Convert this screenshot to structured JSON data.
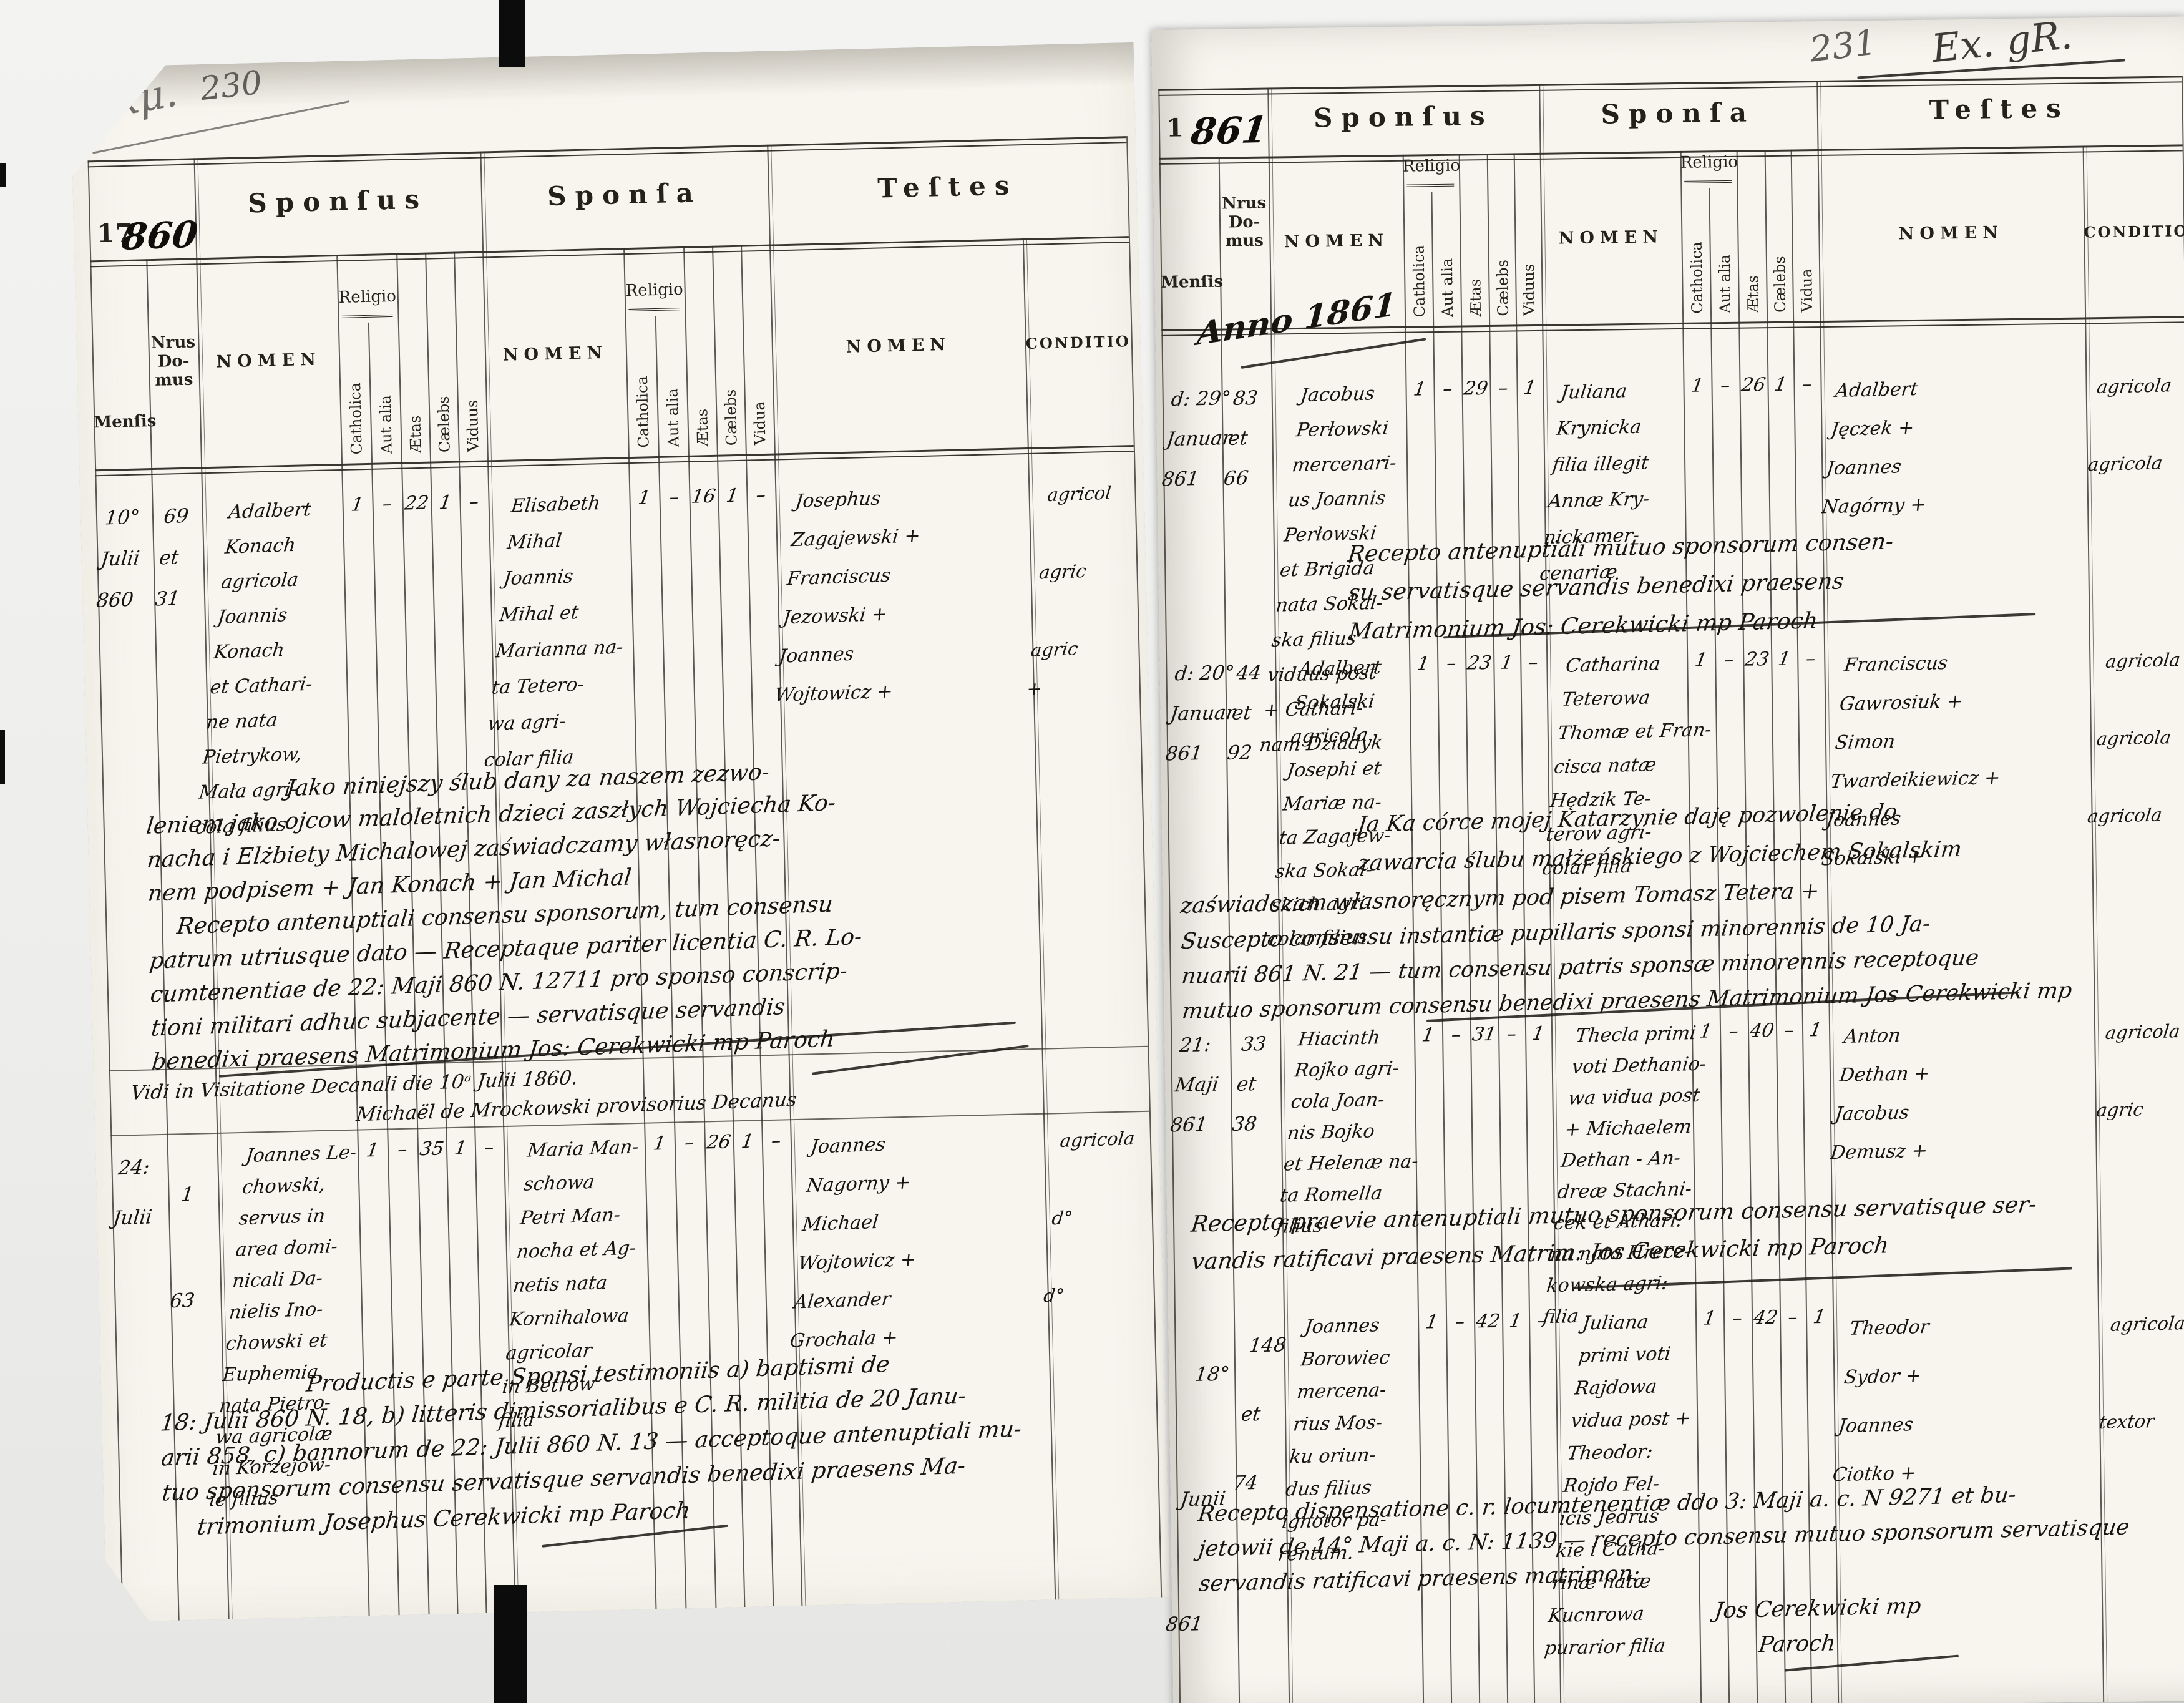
{
  "scan": {
    "left_page_number": "230",
    "right_page_number": "231",
    "left_corner_scribble": "Exμ.",
    "right_corner_scribble": "Ex. gR.",
    "ink_color": "#17140f",
    "pencil_color": "#6f6d68",
    "paper_color": "#f7f5ee"
  },
  "headers": {
    "sponsus": "Sponſus",
    "sponsa": "Sponſa",
    "testes": "Teſtes",
    "mensis": "Menſis",
    "nrus_lines": [
      "Nrus",
      "Do-",
      "mus"
    ],
    "nomen": "NOMEN",
    "conditio": "CONDITIO",
    "religio": "Religio",
    "catholica": "Catholica",
    "aut_alia": "Aut alia",
    "aetas": "Ætas",
    "caelebs": "Cælebs",
    "viduus": "Viduus",
    "vidua": "Vidua"
  },
  "left_page": {
    "year_printed": "17",
    "year_written": "860",
    "records": [
      {
        "mensis": [
          "10°",
          "Julii",
          "860"
        ],
        "nrus": [
          "69",
          "et",
          "31"
        ],
        "sponsus": [
          "Adalbert",
          "Konach",
          "agricola",
          "Joannis",
          "Konach",
          "et Cathari-",
          "ne nata",
          "Pietrykow,",
          "Mała agri-",
          "cola filius"
        ],
        "sponsus_marks": [
          "1",
          "–",
          "22",
          "1",
          "–"
        ],
        "sponsa": [
          "Elisabeth",
          "Mihal",
          "Joannis",
          "Mihal et",
          "Marianna na-",
          "ta Tetero-",
          "wa agri-",
          "colar filia"
        ],
        "sponsa_marks": [
          "1",
          "–",
          "16",
          "1",
          "–"
        ],
        "testes": [
          "Josephus",
          "Zagajewski +",
          "Franciscus",
          "Jezowski +",
          "Joannes",
          "Wojtowicz +"
        ],
        "conditio": [
          "agricol",
          "",
          "agric",
          "",
          "agric",
          "+"
        ]
      },
      {
        "mensis": [
          "24:",
          "Julii"
        ],
        "nrus": [
          "1",
          "63"
        ],
        "sponsus": [
          "Joannes Le-",
          "chowski,",
          "servus in",
          "area domi-",
          "nicali Da-",
          "nielis Ino-",
          "chowski et",
          "Euphemia",
          "nata Pietro-",
          "wa agricolæ",
          "in Korzejow-",
          "ie filius"
        ],
        "sponsus_marks": [
          "1",
          "–",
          "35",
          "1",
          "–"
        ],
        "sponsa": [
          "Maria Man-",
          "schowa",
          "Petri Man-",
          "nocha et Ag-",
          "netis nata",
          "Kornihalowa",
          "agricolar",
          "in Betrow",
          "filia"
        ],
        "sponsa_marks": [
          "1",
          "–",
          "26",
          "1",
          "–"
        ],
        "testes": [
          "Joannes",
          "Nagorny +",
          "Michael",
          "Wojtowicz +",
          "Alexander",
          "Grochala +"
        ],
        "conditio": [
          "agricola",
          "",
          "d°",
          "",
          "d°",
          ""
        ]
      }
    ],
    "notes": [
      {
        "lines": [
          "Jako niniejszy ślub dany za naszem zezwo-",
          "leniem jako ojcow maloletnich dzieci zaszłych Wojciecha Ko-",
          "nacha i Elżbiety Michalowej zaświadczamy własnoręcz-",
          "nem podpisem  + Jan Konach   + Jan Michal",
          "Recepto antenuptiali consensu sponsorum, tum consensu",
          "patrum utriusque dato — Receptaque pariter licentia C. R. Lo-",
          "cumtenentiae de 22: Maji 860 N. 12711 pro sponso conscrip-",
          "tioni militari adhuc subjacente — servatisque servandis",
          "benedixi praesens  Matrimonium  Jos: Cerekwicki mp   Paroch"
        ]
      },
      {
        "lines": [
          "Vidi in Visitatione Decanali die 10ᵃ Julii 1860.",
          "Michaël de Mrockowski provisorius Decanus"
        ]
      },
      {
        "lines": [
          "Productis e parte Sponsi testimoniis a) baptismi de",
          "18: Julii 860 N. 18, b) litteris dimissorialibus e C. R. militia de 20 Janu-",
          "arii 858, c) bannorum de 22: Julii 860 N. 13 — acceptoque antenuptiali mu-",
          "tuo sponsorum consensu servatisque servandis benedixi praesens Ma-",
          "trimonium    Josephus Cerekwicki mp     Paroch"
        ]
      }
    ]
  },
  "right_page": {
    "year_printed": "1",
    "year_written": "861",
    "anno": "Anno 1861",
    "records": [
      {
        "mensis": [
          "d: 29°",
          "Januar",
          "861"
        ],
        "nrus": [
          "83",
          "et",
          "66"
        ],
        "sponsus": [
          "Jacobus",
          "Perłowski",
          "mercenari-",
          "us Joannis",
          "Perłowski",
          "et Brigida",
          "nata Sokal-",
          "ska filius",
          "viduus post",
          "+ Cathari-",
          "nam Dziadyk"
        ],
        "sponsus_marks": [
          "1",
          "–",
          "29",
          "–",
          "1"
        ],
        "sponsa": [
          "Juliana",
          "Krynicka",
          "filia illegit",
          "Annæ Kry-",
          "nickamer-",
          "cenariæ"
        ],
        "sponsa_marks": [
          "1",
          "–",
          "26",
          "1",
          "–"
        ],
        "testes": [
          "Adalbert",
          "Jęczek +",
          "Joannes",
          "Nagórny +"
        ],
        "conditio": [
          "agricola",
          "",
          "agricola",
          ""
        ]
      },
      {
        "mensis": [
          "d: 20°",
          "Januar",
          "861"
        ],
        "nrus": [
          "44",
          "et",
          "92"
        ],
        "sponsus": [
          "Adalbert",
          "Sokalski",
          "agricola",
          "Josephi et",
          "Mariæ na-",
          "ta Zagajew-",
          "ska Sokal-",
          "skich agri-",
          "colar filius"
        ],
        "sponsus_marks": [
          "1",
          "–",
          "23",
          "1",
          "–"
        ],
        "sponsa": [
          "Catharina",
          "Teterowa",
          "Thomæ et Fran-",
          "cisca natæ",
          "Hędzik Te-",
          "terow agri-",
          "colar filia"
        ],
        "sponsa_marks": [
          "1",
          "–",
          "23",
          "1",
          "–"
        ],
        "testes": [
          "Franciscus",
          "Gawrosiuk +",
          "Simon",
          "Twardeikiewicz +",
          "Joannes",
          "Sokalski +"
        ],
        "conditio": [
          "agricola",
          "",
          "agricola",
          "",
          "agricola",
          ""
        ]
      },
      {
        "mensis": [
          "21:",
          "Maji",
          "861"
        ],
        "nrus": [
          "33",
          "et",
          "38"
        ],
        "sponsus": [
          "Hiacinth",
          "Rojko agri-",
          "cola Joan-",
          "nis Bojko",
          "et Helenæ na-",
          "ta Romella",
          "filius"
        ],
        "sponsus_marks": [
          "1",
          "–",
          "31",
          "–",
          "1"
        ],
        "sponsa": [
          "Thecla primi",
          "voti Dethanio-",
          "wa vidua post",
          "+ Michaelem",
          "Dethan - An-",
          "dreæ Stachni-",
          "cek et Athari:",
          "na nata Hrecz-",
          "kowska agri: filia"
        ],
        "sponsa_marks": [
          "1",
          "–",
          "40",
          "–",
          "1"
        ],
        "testes": [
          "Anton",
          "Dethan +",
          "Jacobus",
          "Demusz +"
        ],
        "conditio": [
          "agricola",
          "",
          "agric",
          ""
        ]
      },
      {
        "mensis": [
          "18°",
          "Junii",
          "861"
        ],
        "nrus": [
          "148",
          "et",
          "74"
        ],
        "sponsus": [
          "Joannes",
          "Borowiec",
          "mercena-",
          "rius Mos-",
          "ku oriun-",
          "dus filius",
          "ignotor pa-",
          "rentum."
        ],
        "sponsus_marks": [
          "1",
          "–",
          "42",
          "1",
          "–"
        ],
        "sponsa": [
          "Juliana",
          "primi voti",
          "Rajdowa",
          "vidua post +",
          "Theodor:",
          "Rojdo Fel-",
          "icis Jedrus",
          "kie i Catha-",
          "rinæ natæ",
          "Kucnrowa",
          "purarior filia"
        ],
        "sponsa_marks": [
          "1",
          "–",
          "42",
          "–",
          "1"
        ],
        "testes": [
          "Theodor",
          "Sydor +",
          "Joannes",
          "Ciotko +"
        ],
        "conditio": [
          "agricola",
          "",
          "textor",
          ""
        ]
      }
    ],
    "notes": [
      {
        "lines": [
          "Recepto antenuptiali mutuo sponsorum consen-",
          "su servatisque servandis benedixi praesens",
          "Matrimonium Jos: Cerekwicki mp     Paroch"
        ]
      },
      {
        "lines": [
          "Ja Ka córce mojej Katarzynie daję pozwolenie do",
          "zawarcia ślubu małżeńskiego z Wojciechem Sokalskim",
          "zaświadczam własnoręcznym pod pisem  Tomasz Tetera +",
          "Suscepto consensu instantiæ pupillaris sponsi minorennis de 10 Ja-",
          "nuarii 861 N. 21 — tum consensu patris sponsæ minorennis receptoque",
          "mutuo sponsorum consensu benedixi praesens Matrimonium Jos Cerekwicki mp"
        ]
      },
      {
        "lines": [
          "Recepto praevie antenuptiali mutuo sponsorum consensu servatisque ser-",
          "vandis ratificavi praesens Matrim:  Jos Cerekwicki mp     Paroch"
        ]
      },
      {
        "lines": [
          "Recepto dispensatione c. r. locumtenentiæ ddo 3: Maji a. c. N 9271 et bu-",
          "jetowii de 14° Maji a. c. N: 1139 — recepto consensu mutuo sponsorum servatisque",
          "servandis ratificavi praesens matrimon:",
          "Jos Cerekwicki mp",
          "Paroch"
        ]
      }
    ]
  }
}
